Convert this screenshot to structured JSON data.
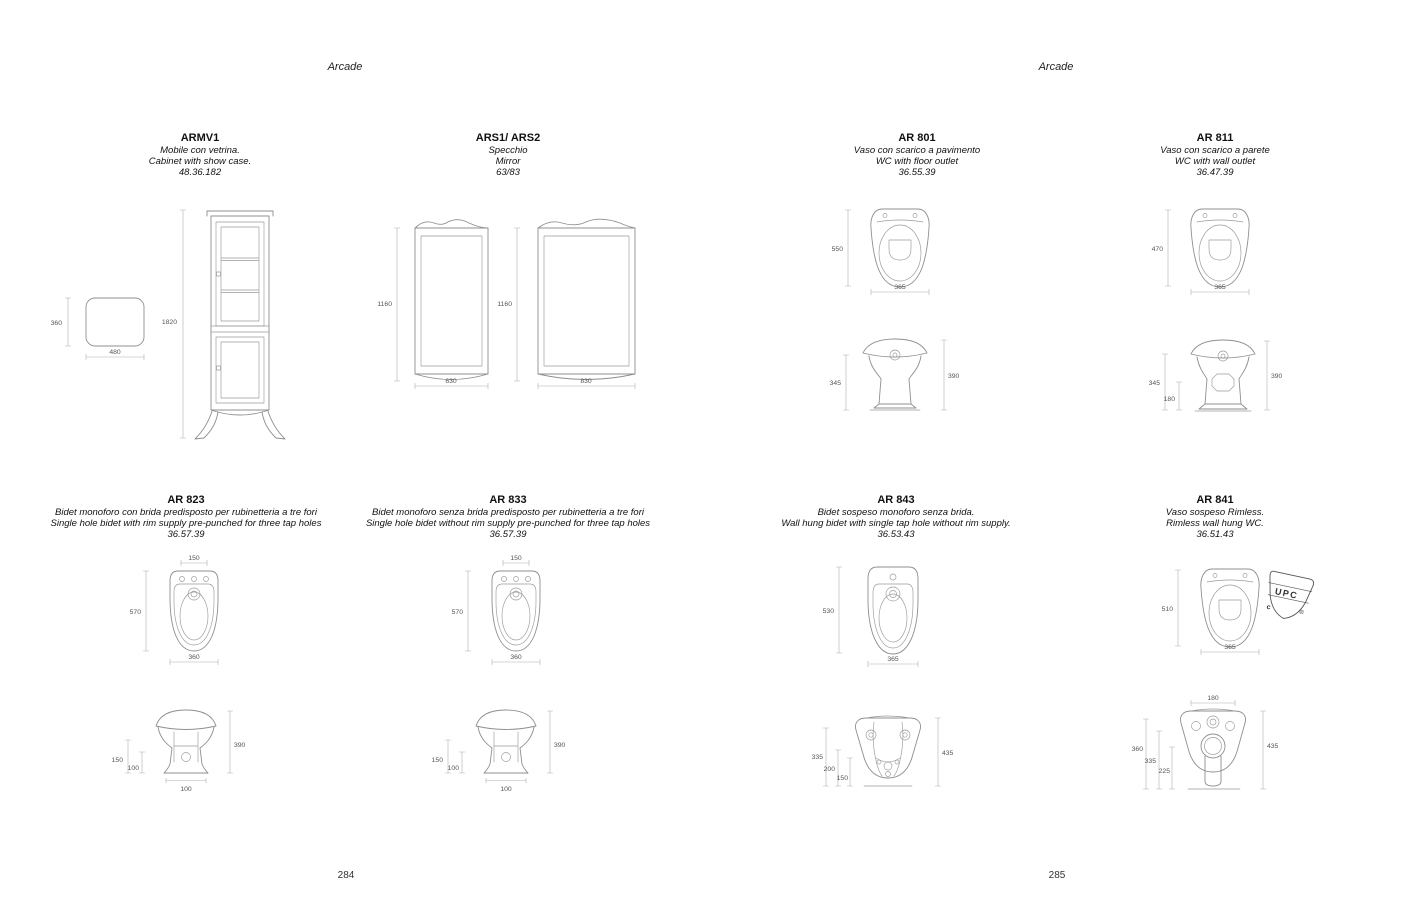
{
  "headers": {
    "left": "Arcade",
    "right": "Arcade"
  },
  "page_numbers": {
    "left": "284",
    "right": "285"
  },
  "products": {
    "armv1": {
      "code": "ARMV1",
      "desc_it": "Mobile con vetrina.",
      "desc_en": "Cabinet with show case.",
      "ref": "48.36.182",
      "dims": {
        "depth": "360",
        "width": "480",
        "height": "1820"
      }
    },
    "ars": {
      "code": "ARS1/ ARS2",
      "desc_it": "Specchio",
      "desc_en": "Mirror",
      "ref": "63/83",
      "dims": {
        "mirror1_height": "1160",
        "mirror1_width": "630",
        "mirror2_height": "1160",
        "mirror2_width": "830"
      }
    },
    "ar801": {
      "code": "AR 801",
      "desc_it": "Vaso con scarico a pavimento",
      "desc_en": "WC with floor outlet",
      "ref": "36.55.39",
      "dims": {
        "top_depth": "550",
        "top_width": "365",
        "front_left": "345",
        "front_right": "390"
      }
    },
    "ar811": {
      "code": "AR 811",
      "desc_it": "Vaso con scarico a parete",
      "desc_en": "WC with wall outlet",
      "ref": "36.47.39",
      "dims": {
        "top_depth": "470",
        "top_width": "365",
        "front_left": "345",
        "front_outlet": "180",
        "front_right": "390"
      }
    },
    "ar823": {
      "code": "AR 823",
      "desc_it": "Bidet monoforo con brida predisposto per rubinetteria a tre fori",
      "desc_en": "Single hole bidet with rim supply pre-punched for three tap holes",
      "ref": "36.57.39",
      "dims": {
        "top_holes": "150",
        "top_depth": "570",
        "top_width": "360",
        "front_left1": "150",
        "front_left2": "100",
        "front_right": "390",
        "front_base": "100"
      }
    },
    "ar833": {
      "code": "AR 833",
      "desc_it": "Bidet monoforo senza brida predisposto per rubinetteria a tre fori",
      "desc_en": "Single hole bidet without rim supply pre-punched for three tap holes",
      "ref": "36.57.39",
      "dims": {
        "top_holes": "150",
        "top_depth": "570",
        "top_width": "360",
        "front_left1": "150",
        "front_left2": "100",
        "front_right": "390",
        "front_base": "100"
      }
    },
    "ar843": {
      "code": "AR 843",
      "desc_it": "Bidet sospeso monoforo senza brida.",
      "desc_en": "Wall hung bidet with single tap hole without rim supply.",
      "ref": "36.53.43",
      "dims": {
        "top_depth": "530",
        "top_width": "365",
        "rear_left1": "335",
        "rear_left2": "200",
        "rear_left3": "150",
        "rear_right": "435"
      }
    },
    "ar841": {
      "code": "AR 841",
      "desc_it": "Vaso sospeso Rimless.",
      "desc_en": "Rimless wall hung WC.",
      "ref": "36.51.43",
      "dims": {
        "top_depth": "510",
        "top_width": "365",
        "rear_top": "180",
        "rear_left1": "360",
        "rear_left2": "335",
        "rear_left3": "225",
        "rear_right": "435"
      },
      "upc": {
        "label": "UPC",
        "c": "c",
        "r": "®"
      }
    }
  }
}
